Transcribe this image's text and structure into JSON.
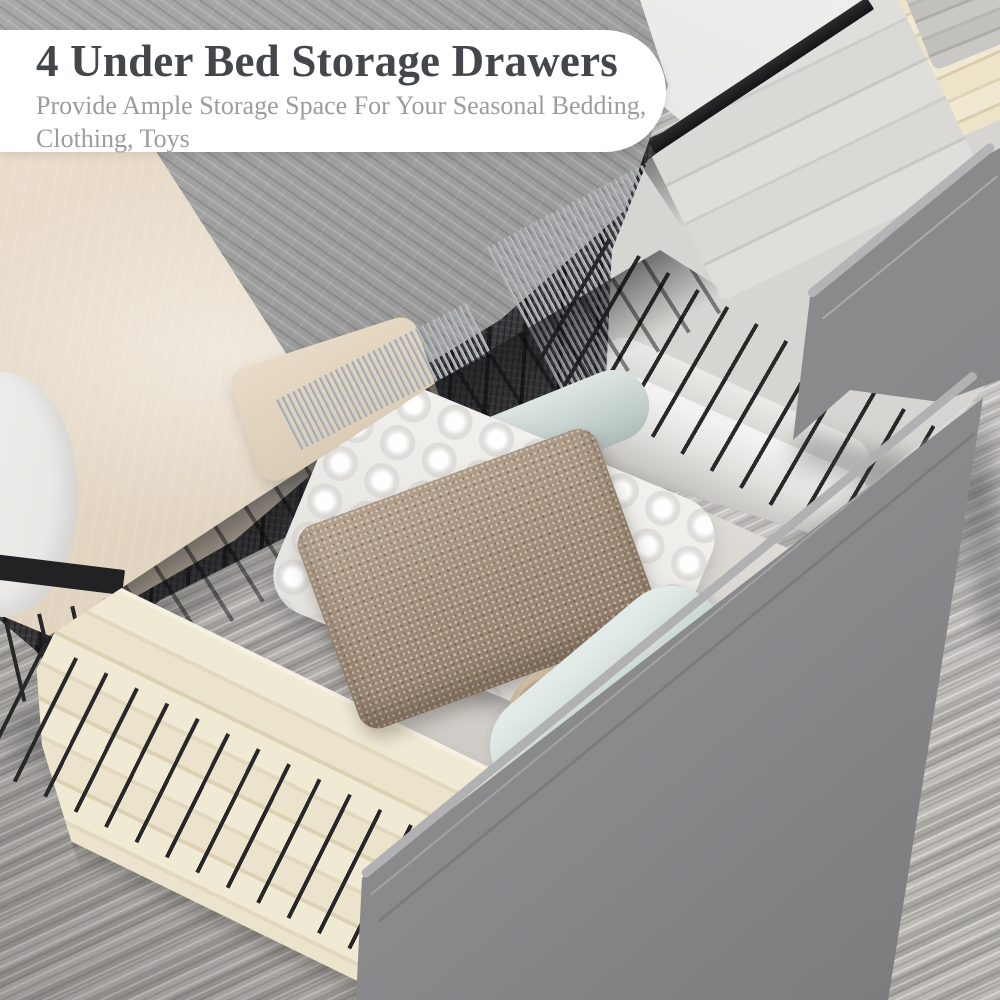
{
  "callout": {
    "title": "4 Under Bed Storage Drawers",
    "subtitle_line1": "Provide Ample Storage Space For Your Seasonal Bedding,",
    "subtitle_line2": "Clothing, Toys"
  },
  "colors": {
    "card-bg": "#ffffff",
    "title-text": "#43464a",
    "subtitle-text": "#9c9c9c",
    "carpet-base": "#b5b2ae",
    "blanket-gray": "#939493",
    "sheet-beige": "#e0d4c2",
    "mattress-white": "#f2f1ef",
    "frame-black": "#222224",
    "mesh-dark": "#333336",
    "panel-gray": "#8a8a8d",
    "linen-cream": "#ebe3cb",
    "linen-white": "#dbd9d5",
    "towel-taupe": "#a18e7a",
    "towel-mint": "#c6d3d0",
    "pillow-white": "#edebe8",
    "fringe-gray": "#a6abaf"
  }
}
